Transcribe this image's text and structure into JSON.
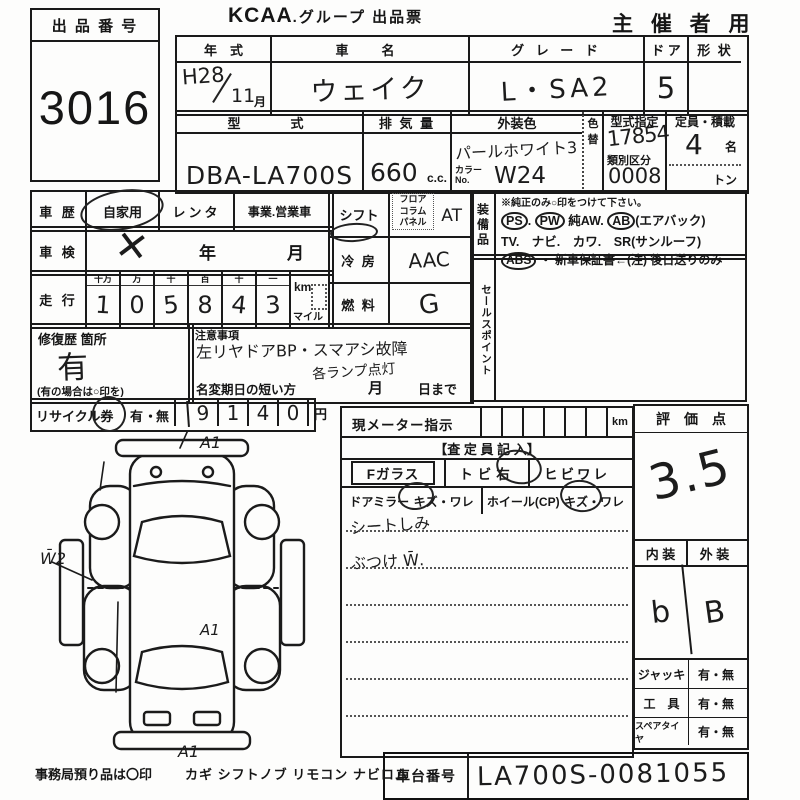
{
  "header": {
    "lot_label": "出 品 番 号",
    "lot_number": "3016",
    "brand": "KCAA",
    "title_rest": ".グループ 出品票",
    "audience": "主 催 者 用"
  },
  "vehicle": {
    "year_label": "年　式",
    "year_era": "H28",
    "year_month": "11",
    "month_unit": "月",
    "name_label": "車　名",
    "name_value": "ウェイク",
    "grade_label": "グ レ ー ド",
    "grade_value": "L・SA2",
    "door_label": "ド ア",
    "door_value": "5",
    "shape_label": "形 状",
    "model_label": "型　　式",
    "model_value": "DBA-LA700S",
    "displacement_label": "排 気 量",
    "displacement_value": "660",
    "displacement_unit": "c.c.",
    "color_label": "外装色",
    "color_value": "パールホワイト3",
    "color_change_label": "色替",
    "color_no_label": "カラーNo.",
    "color_no_value": "W24",
    "type_designation_label": "型式指定",
    "type_designation_value": "17854",
    "class_division_label": "類別区分",
    "class_division_value": "0008",
    "capacity_label": "定員・積載",
    "capacity_value": "4",
    "capacity_unit": "名",
    "load_unit": "トン"
  },
  "history": {
    "label": "車 歴",
    "private": "自家用",
    "rental": "レンタ",
    "business": "事業.営業車",
    "inspection_label": "車 検",
    "inspection_mark": "✕",
    "year_unit": "年",
    "month_unit": "月",
    "mileage_label": "走 行",
    "digit_headers": [
      "十万",
      "万",
      "千",
      "百",
      "十",
      "一"
    ],
    "digits": [
      "1",
      "0",
      "5",
      "8",
      "4",
      "3"
    ],
    "unit_km": "km",
    "unit_mile": "マイル"
  },
  "repair": {
    "label": "修復歴 箇所",
    "value": "有",
    "note": "(有の場合は○印を)"
  },
  "recycle": {
    "label": "リサイクル券",
    "yes": "有",
    "sep": "・",
    "no": "無",
    "digits": [
      "9",
      "1",
      "4",
      "0"
    ],
    "unit": "円"
  },
  "powertrain": {
    "shift_label": "シフト",
    "shift_opt1": "フロア",
    "shift_opt2": "コラム",
    "shift_opt3": "パネル",
    "shift_value": "AT",
    "ac_label": "冷 房",
    "ac_value": "AAC",
    "fuel_label": "燃 料",
    "fuel_value": "G"
  },
  "notes": {
    "label": "注意事項",
    "line1": "左リヤドアBP・スマアシ故障",
    "line2": "各ランプ点灯",
    "rename_label": "名変期日の短い方",
    "month_unit": "月",
    "day_suffix": "日まで"
  },
  "equipment": {
    "vertical_label": "装備品",
    "instruction": "※純正のみ○印をつけて下さい。",
    "e1": "PS",
    "e1d": ".",
    "e2": "PW",
    "e3": "純AW.",
    "e4": "AB",
    "e5": "(エアバック)",
    "line2": "TV.　ナビ.　カワ.　SR(サンルーフ)",
    "abs": "ABS",
    "line3_rest": "・ 新車保証書←(注) 後日送りのみ"
  },
  "salespoint": {
    "vertical_label": "セールスポイント"
  },
  "meter": {
    "label": "現メーター指示",
    "unit": "km"
  },
  "assessor": {
    "header": "【査 定 員 記 入】",
    "f_glass": "Fガラス",
    "tobi": "トビ右",
    "hibiware": "ヒビワレ",
    "mirror": "ドアミラー",
    "mirror_state": "キズ・ワレ",
    "wheel": "ホイール(CP)",
    "wheel_state": "キズ・ワレ",
    "note1": "シートしみ",
    "note2": "ぶつけ W̄."
  },
  "evaluation": {
    "label": "評　価　点",
    "score": "3.5",
    "interior_label": "内 装",
    "exterior_label": "外 装",
    "interior_value": "b",
    "exterior_value": "B"
  },
  "accessories": {
    "jack_label": "ジャッキ",
    "jack_value": "有・無",
    "tool_label": "工　具",
    "tool_value": "有・無",
    "spare_label": "スペアタイヤ",
    "spare_value": "有・無"
  },
  "chassis": {
    "label": "車台番号",
    "value": "LA700S-0081055"
  },
  "footer": {
    "office": "事務局預り品は〇印",
    "items": "カギ シフトノブ リモコン ナビロム"
  },
  "diagram": {
    "front": "A1",
    "left": "W̄2",
    "mid": "A1",
    "rear": "A1"
  }
}
